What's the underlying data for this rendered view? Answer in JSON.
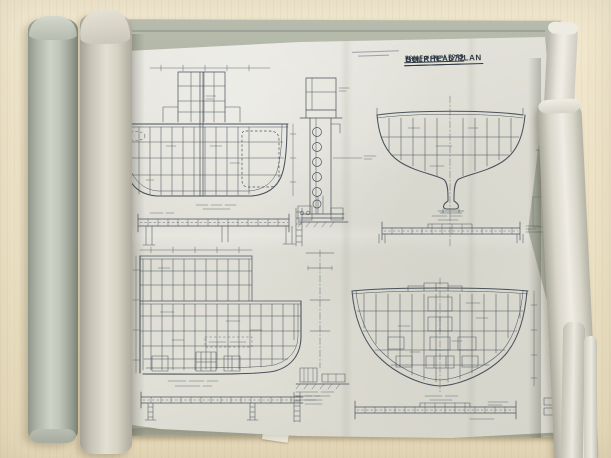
{
  "title_block": {
    "ship_number": "SHIP Nº 572",
    "plan_title": "BULKHEAD PLAN",
    "scale_note": "SCALE ½ IN = 1 FOOT"
  },
  "colors": {
    "table": "#eee3c6",
    "table_light": "#f2e8cf",
    "table_grain": "#e0d2ad",
    "under_sheet": "#b2b7a8",
    "sheet": "#dddcd3",
    "sheet_light": "#e8e7e0",
    "roll_gray": "#b5bbaf",
    "roll_cream": "#d9d5c8",
    "roll_white": "#e9e6dd",
    "ink": "#49525c",
    "ink_dark": "#2f3a44",
    "stamp": "#8f959d"
  }
}
